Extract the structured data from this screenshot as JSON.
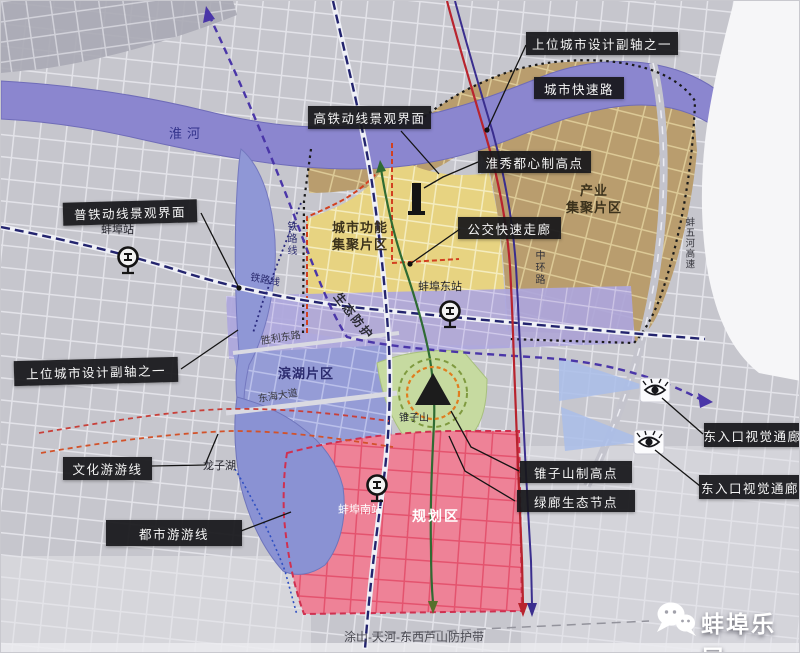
{
  "app": {
    "watermark": "蚌埠乐居"
  },
  "colors": {
    "river": "#8b86cf",
    "industry_zone": "#c0a374",
    "function_zone": "#e9d688",
    "eco_band": "#b3abdd",
    "binhu_zone": "#9aa1d6",
    "planning_zone": "#e7556f",
    "green_hill": "#c6daa0",
    "lake": "#8a92d3",
    "callout_bg": "#1a1a1c",
    "rail_blue": "#23246e",
    "axis_purple": "#4a36a8",
    "brt_red": "#b8242e",
    "eco_green": "#2f6b33"
  },
  "callouts": [
    {
      "id": "sub-axis-top",
      "text": "上位城市设计副轴之一"
    },
    {
      "id": "city-expressway",
      "text": "城市快速路"
    },
    {
      "id": "hsr-landscape",
      "text": "高铁动线景观界面"
    },
    {
      "id": "huaixiu-highpoint",
      "text": "淮秀都心制高点"
    },
    {
      "id": "rail-landscape",
      "text": "普铁动线景观界面"
    },
    {
      "id": "brt-corridor",
      "text": "公交快速走廊"
    },
    {
      "id": "sub-axis-left",
      "text": "上位城市设计副轴之一"
    },
    {
      "id": "culture-tour-line",
      "text": "文化游游线"
    },
    {
      "id": "urban-tour-line",
      "text": "都市游游线"
    },
    {
      "id": "zhuizishan-highpoint",
      "text": "锥子山制高点"
    },
    {
      "id": "green-eco-node",
      "text": "绿廊生态节点"
    },
    {
      "id": "east-visual-corridor-1",
      "text": "东入口视觉通廊"
    },
    {
      "id": "east-visual-corridor-2",
      "text": "东入口视觉通廊"
    }
  ],
  "labels": [
    {
      "id": "huai-river",
      "text": "淮河"
    },
    {
      "id": "bengbu-station",
      "text": "蚌埠站"
    },
    {
      "id": "railway-line-vertical",
      "text": "铁路线"
    },
    {
      "id": "railway-line",
      "text": "铁路线"
    },
    {
      "id": "urban-function-zone",
      "text": "城市功能\n集聚片区"
    },
    {
      "id": "bengbu-east-station",
      "text": "蚌埠东站"
    },
    {
      "id": "middle-ring-road",
      "text": "中环路"
    },
    {
      "id": "industry-zone",
      "text": "产业\n集聚片区"
    },
    {
      "id": "bengwu-expressway",
      "text": "蚌五河高速"
    },
    {
      "id": "shengli-east-road",
      "text": "胜利东路"
    },
    {
      "id": "binhu-zone",
      "text": "滨湖片区"
    },
    {
      "id": "donghai-avenue",
      "text": "东海大道"
    },
    {
      "id": "eco-protection",
      "text": "生态防护"
    },
    {
      "id": "zhuizishan",
      "text": "锥子山"
    },
    {
      "id": "longzihu",
      "text": "龙子湖"
    },
    {
      "id": "bengbu-south-station",
      "text": "蚌埠南站"
    },
    {
      "id": "planning-zone",
      "text": "规划区"
    },
    {
      "id": "protection-belt",
      "text": "涂山-天河-东西芦山防护带"
    }
  ]
}
